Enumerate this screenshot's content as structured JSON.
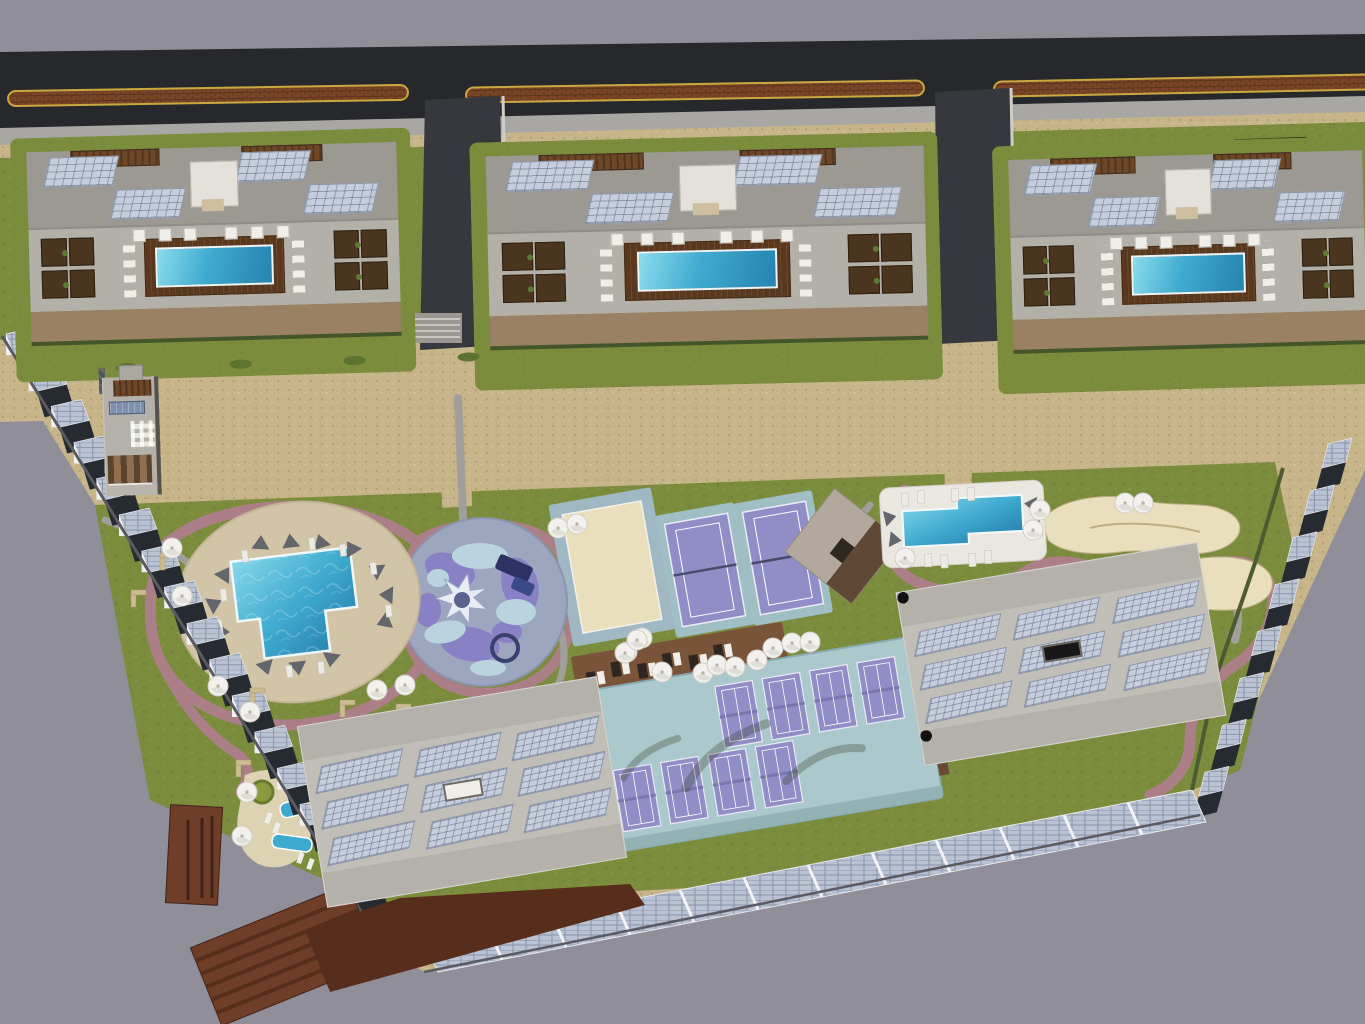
{
  "scene": {
    "description": "Top-down aerial 3D architectural rendering of a resort residential masterplan with a main road, three apartment blocks with rooftop pools, a townhouse row, leisure park, sports courts and solar panel installations",
    "view": "top-down aerial render",
    "has_text": false
  },
  "colors": {
    "bg": "#8F8E99",
    "asphalt": "#26282B",
    "median": "#7A4527",
    "medianEdge": "#C9A93F",
    "sidewalk": "#A8A7A3",
    "lawn": "#7C8C3D",
    "lawnDark": "#2E4420",
    "roofGray": "#B4B1AB",
    "roofDark": "#9C9992",
    "solar": "#C6CEDD",
    "solarGrid": "#93A0B8",
    "solarDark": "#7F90AF",
    "poolBlue": "#3FAACF",
    "poolDeep": "#2683B0",
    "wood": "#6E4728",
    "balconyTan": "#94744F",
    "hedge": "#45552A",
    "gravel": "#C7B488",
    "pathPink": "#AC7F88",
    "pathGray": "#A19F9C",
    "courtPurple": "#918DC7",
    "courtTeal": "#ABC8CC",
    "sand": "#E9DFBC",
    "sandLine": "#BFAE85",
    "splashBase": "#9DA6BF",
    "splashPurple": "#8981C5",
    "splashBlue": "#B9D4DF",
    "white": "#F2F1ED",
    "panelLight": "#B9C3D3",
    "shadow": "#262B31",
    "rust": "#6F3E28",
    "rustDark": "#572E1C",
    "deckBeige": "#D2C5A7",
    "alley": "#36383D",
    "treeGreen": "#3E5524",
    "navy": "#2C3263"
  },
  "road": {
    "median_strips": 3,
    "median_material": "brick planter with yellow kerb"
  },
  "apartment_blocks": {
    "count": 3,
    "features_per_block": {
      "rooftop_pool": 1,
      "solar_arrays": 4,
      "pergola_lounges": 2,
      "cabanas": 6,
      "balcony_bays": 10,
      "lounge_clusters": 2
    }
  },
  "townhouses": {
    "total": 19,
    "groups": [
      6,
      8,
      5
    ],
    "unit_features": [
      "chimney",
      "timber pergola",
      "rooftop solar panel",
      "AC units",
      "balcony"
    ]
  },
  "south_buildings": {
    "count": 2,
    "features": [
      "perimeter balconies",
      "rooftop solar arrays",
      "central skylight"
    ]
  },
  "amenities": {
    "main_pool": {
      "shape": "stepped freeform",
      "deck": "oval beige"
    },
    "kids_splash_pad": {
      "shape": "circular",
      "star_feature": 1,
      "play_structures": 2
    },
    "beach_volleyball_courts": 1,
    "tennis_courts": 2,
    "padel_courts": 8,
    "clubhouse": 1,
    "secondary_pool": 1,
    "spa_pools": 2,
    "sand_gardens": 2,
    "white_umbrellas": 27,
    "benches": 6
  },
  "solar_infrastructure": {
    "left_boundary_sawtooth_panels": 17,
    "right_boundary_sawtooth_panels": 8,
    "bottom_row_panel_segments": 12,
    "rooftops": "all buildings carry PV arrays"
  },
  "landscape": {
    "lawns": "green",
    "walking_paths": "pink and grey loops",
    "perimeter": "gravel",
    "warehouse_structures": 3
  }
}
